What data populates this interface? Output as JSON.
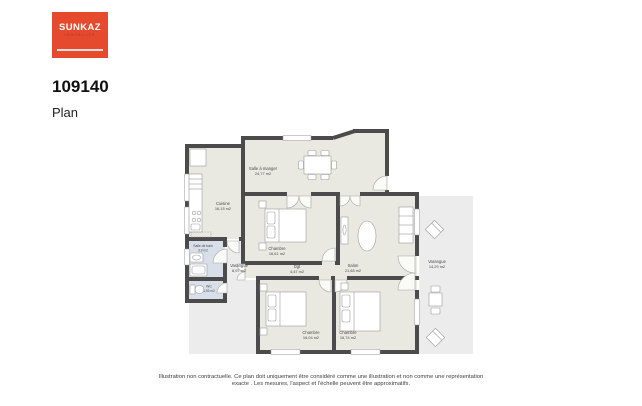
{
  "logo": {
    "name": "SUNKAZ",
    "subtitle": "IMMOBILIER"
  },
  "header": {
    "reference": "109140",
    "page_title": "Plan"
  },
  "plan": {
    "rooms": [
      {
        "name": "Salle à manger",
        "area": "24,77 m2"
      },
      {
        "name": "Cuisine",
        "area": "16,15 m2"
      },
      {
        "name": "Chambre",
        "area": "16,61 m2"
      },
      {
        "name": "Dgt",
        "area": "4,47 m2"
      },
      {
        "name": "Salon",
        "area": "21,68 m2"
      },
      {
        "name": "Varangue",
        "area": "8,97 m2"
      },
      {
        "name": "Varangue",
        "area": "14,29 m2"
      },
      {
        "name": "Salle de bain",
        "area": "3,9 m2"
      },
      {
        "name": "WC",
        "area": "1,93 m2"
      },
      {
        "name": "Chambre",
        "area": "16,04 m2"
      },
      {
        "name": "Chambre",
        "area": "16,74 m2"
      }
    ]
  },
  "footer": {
    "disclaimer": "Illustration non contractuelle. Ce plan doit uniquement être considéré comme une illustration et non comme une représentation exacte . Les mesures, l'aspect et l'échelle peuvent être approximatifs."
  },
  "colors": {
    "brand": "#e64a2e",
    "wall": "#4b4b4b",
    "room_fill": "#e9e9e2",
    "wet_room_fill": "#d9dfe9",
    "varangue_fill": "#ececec"
  }
}
